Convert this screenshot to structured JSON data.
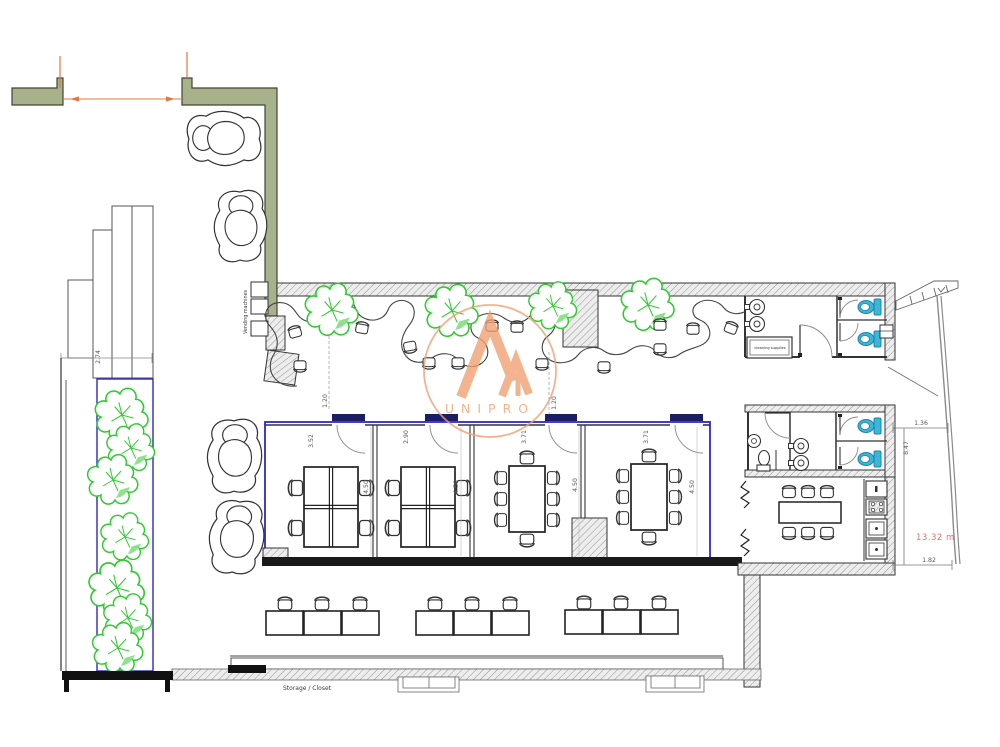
{
  "watermark": {
    "brand": "UNIPRO",
    "color": "#efa173"
  },
  "labels": {
    "vending_machines": "Vending machines",
    "cleaning_supplies": "cleaning supplies",
    "storage_closet": "Storage / Closet"
  },
  "dimensions": {
    "planter_width": "2.74",
    "lounge_left": "1.20",
    "lounge_right": "1.20",
    "office_1_width": "3.52",
    "office_2_width": "2.90",
    "meeting_1_width": "3.71",
    "meeting_2_width": "3.71",
    "room_depth": "4.50",
    "right_wing_top": "1.36",
    "right_wing_height": "8.47",
    "right_wing_area": "13.32 m",
    "right_wing_bottom": "1.82"
  },
  "colors": {
    "wall_green": "#a7b28a",
    "accent_orange": "#e0793f",
    "room_outline_blue": "#2b2bbd",
    "tree_green": "#2ecc2e",
    "toilet_cyan": "#3ab6d9",
    "dimension_red": "#e07070",
    "watermark_orange": "#efa173"
  }
}
